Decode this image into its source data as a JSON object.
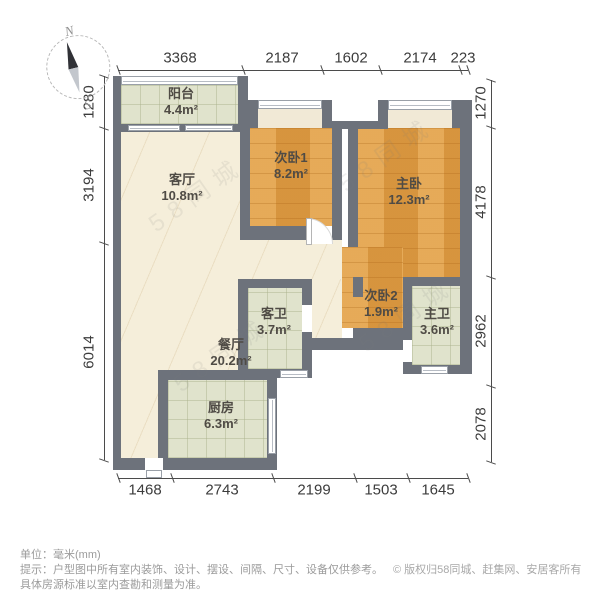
{
  "compass": {
    "north": "N",
    "south": "S"
  },
  "rooms": [
    {
      "name": "阳台",
      "area": "4.4m²"
    },
    {
      "name": "客厅",
      "area": "10.8m²"
    },
    {
      "name": "次卧1",
      "area": "8.2m²"
    },
    {
      "name": "主卧",
      "area": "12.3m²"
    },
    {
      "name": "次卧2",
      "area": "1.9m²"
    },
    {
      "name": "客卫",
      "area": "3.7m²"
    },
    {
      "name": "主卫",
      "area": "3.6m²"
    },
    {
      "name": "餐厅",
      "area": "20.2m²"
    },
    {
      "name": "厨房",
      "area": "6.3m²"
    }
  ],
  "dimensions": {
    "top": [
      "3368",
      "2187",
      "1602",
      "2174",
      "223"
    ],
    "bottom": [
      "1468",
      "2743",
      "2199",
      "1503",
      "1645"
    ],
    "left": [
      "1280",
      "3194",
      "6014"
    ],
    "right": [
      "1270",
      "4178",
      "2962",
      "2078"
    ]
  },
  "watermark": {
    "text": "58同城"
  },
  "footer": {
    "unit_note": "单位：毫米(mm)",
    "tip_line1": "提示：户型图中所有室内装饰、设计、摆设、间隔、尺寸、设备仅供参考。",
    "tip_line2": "具体房源标准以室内查勘和测量为准。",
    "copyright": "© 版权归58同城、赶集网、安居客所有"
  },
  "colors": {
    "wall": "#6d727b",
    "wood_floor": "#dd9c44",
    "tile_floor": "#e0e3cc",
    "marble_floor": "#f5eeda"
  }
}
